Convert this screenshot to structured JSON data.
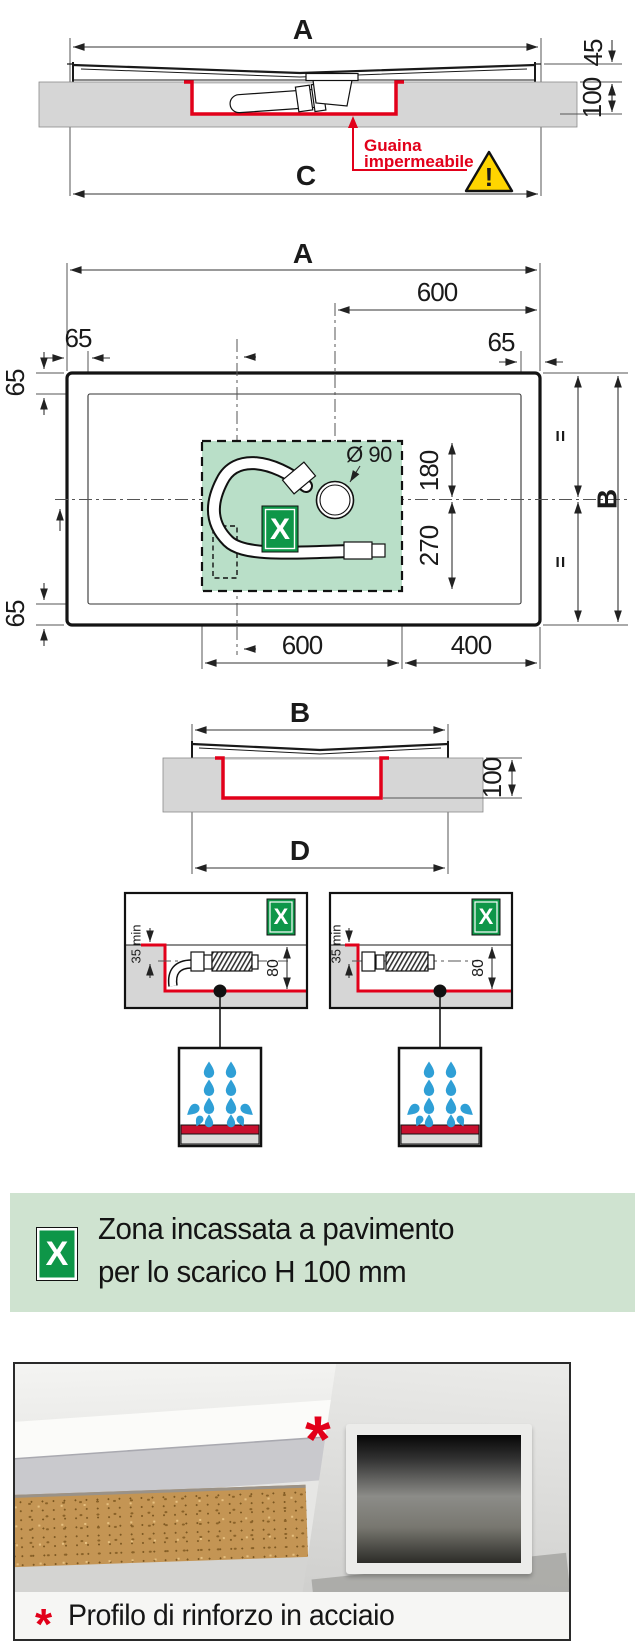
{
  "colors": {
    "red": "#e2001a",
    "zone_green": "#b9dfc8",
    "badge_green": "#0e9648",
    "banner_green": "#cfe3d0",
    "slab_gray": "#d6d6d6",
    "drop_blue": "#2f9fd6",
    "warning_yellow": "#ffd500"
  },
  "top_section": {
    "dim_a": "A",
    "dim_45": "45",
    "dim_100": "100",
    "dim_c": "C",
    "leader_line1": "Guaina",
    "leader_line2": "impermeabile",
    "warning_mark": "!"
  },
  "plan_section": {
    "dim_a": "A",
    "dim_600_top": "600",
    "dim_65": "65",
    "diameter": "Ø 90",
    "dim_180": "180",
    "dim_270": "270",
    "dim_600_bottom": "600",
    "dim_400": "400",
    "dim_b": "B",
    "equal_mark": "=",
    "zone_label": "X"
  },
  "b_section": {
    "dim_b": "B",
    "dim_100": "100",
    "dim_d": "D"
  },
  "detail_section": {
    "zone_label": "X",
    "dim_35min": "35 min",
    "dim_80": "80"
  },
  "legend_banner": {
    "zone_label": "X",
    "line1": "Zona incassata a pavimento",
    "line2": "per lo scarico H 100 mm"
  },
  "photo_section": {
    "marker": "*",
    "caption": "Profilo di rinforzo in acciaio"
  }
}
